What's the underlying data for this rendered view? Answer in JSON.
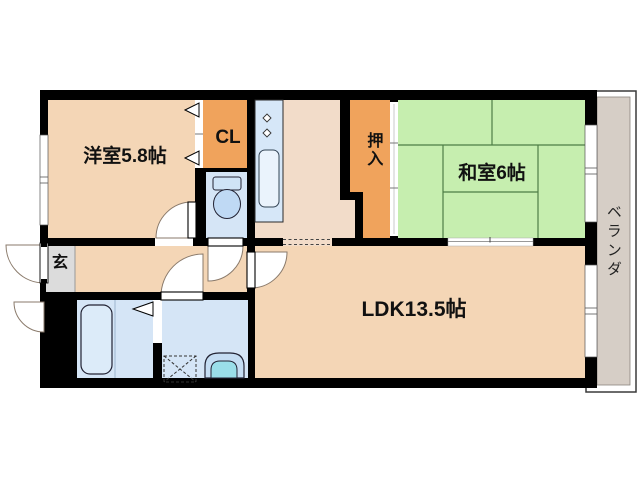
{
  "plan": {
    "type": "apartment-floorplan",
    "rooms": {
      "western_room": {
        "label": "洋室5.8帖"
      },
      "closet": {
        "label": "CL"
      },
      "oshiire": {
        "label": "押入"
      },
      "japanese_room": {
        "label": "和室6帖"
      },
      "ldk": {
        "label": "LDK13.5帖"
      },
      "entrance": {
        "label": "玄"
      },
      "veranda": {
        "label": "ベランダ"
      }
    },
    "colors": {
      "wall": "#000000",
      "room_floor_peach": "#f4d6b6",
      "hall_floor_light": "#f2dcc9",
      "closet_orange": "#f0a35c",
      "tatami_green": "#c6eeaf",
      "wet_area_blue": "#d5e5f6",
      "entrance_gray": "#dcdcdc",
      "veranda_gray": "#d6cec6"
    }
  }
}
